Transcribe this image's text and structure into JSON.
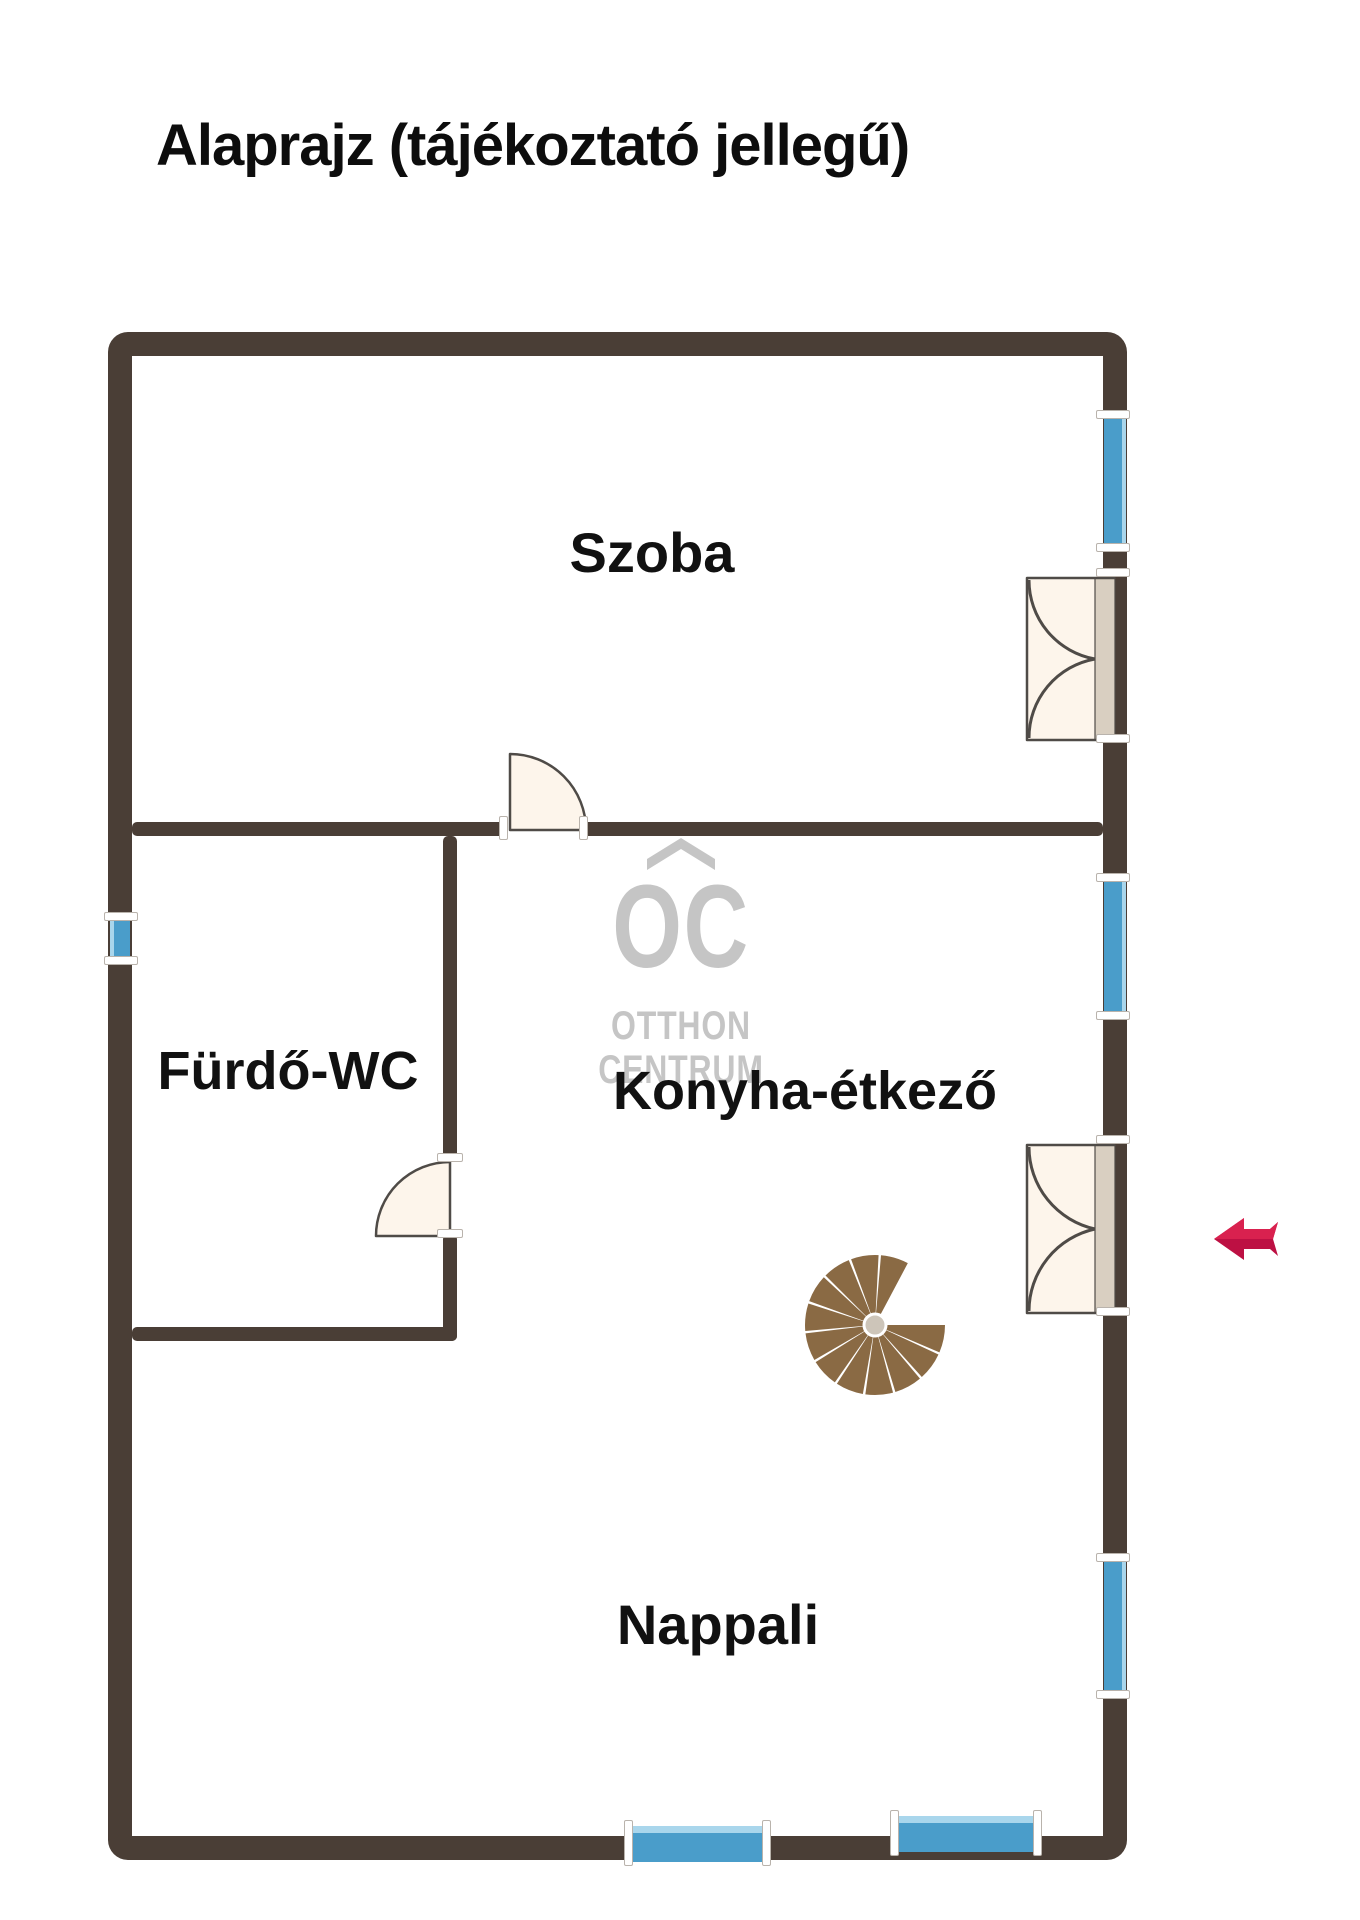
{
  "title": "Alaprajz (tájékoztató jellegű)",
  "rooms": {
    "szoba": {
      "label": "Szoba"
    },
    "furdo": {
      "label": "Fürdő-WC"
    },
    "konyha": {
      "label": "Konyha-étkező"
    },
    "nappali": {
      "label": "Nappali"
    }
  },
  "watermark": {
    "symbol": "OC",
    "line1": "OTTHON",
    "line2": "CENTRUM"
  },
  "features": {
    "windows": [
      {
        "wall": "right",
        "position": "top"
      },
      {
        "wall": "right",
        "position": "middle"
      },
      {
        "wall": "right",
        "position": "bottom"
      },
      {
        "wall": "left",
        "position": "middle"
      },
      {
        "wall": "bottom",
        "position": "left"
      },
      {
        "wall": "bottom",
        "position": "right"
      }
    ],
    "doors": [
      {
        "type": "double",
        "location": "right wall – Szoba"
      },
      {
        "type": "double",
        "location": "right wall – entrance"
      },
      {
        "type": "single",
        "location": "Szoba interior"
      },
      {
        "type": "single",
        "location": "Fürdő-WC"
      }
    ],
    "staircase": {
      "type": "spiral"
    },
    "entrance_arrow": {
      "direction": "left"
    }
  },
  "colors": {
    "wall": "#4a3e36",
    "window": "#4a9dca",
    "window_light": "#a9d6ec",
    "door_fill": "#fdf5eb",
    "door_slab": "#d9cfc1",
    "outline": "#4f4b47",
    "logo": "#c5c5c5",
    "arrow": "#d9214f",
    "arrow_dark": "#bd1043",
    "wood": "#8a6a44",
    "hub": "#cdc5b9",
    "text": "#151515",
    "cap_border": "#b9b3ac"
  }
}
